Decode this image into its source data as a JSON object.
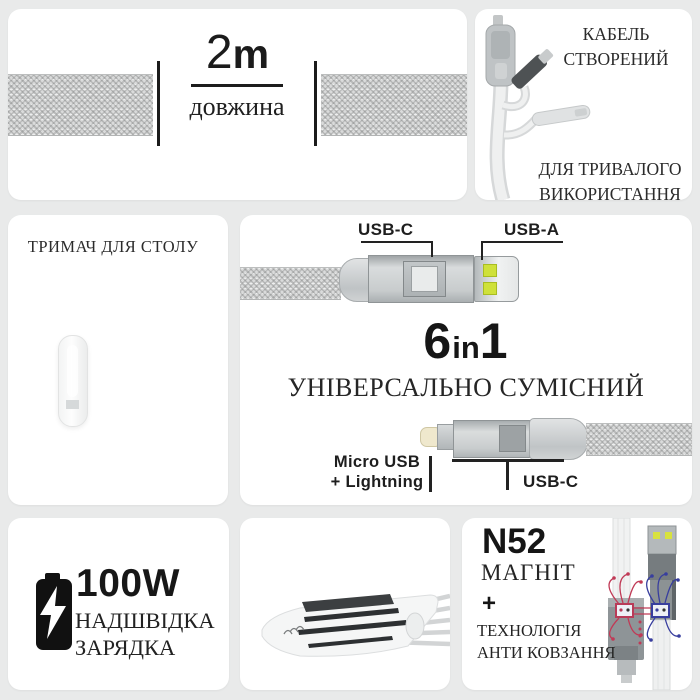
{
  "cards": {
    "length": {
      "value": "2",
      "unit": "m",
      "label": "довжина"
    },
    "durable": {
      "title_line1": "КАБЕЛЬ",
      "title_line2": "СТВОРЕНИЙ",
      "footer_line1": "ДЛЯ ТРИВАЛОГО",
      "footer_line2": "ВИКОРИСТАННЯ"
    },
    "holder": {
      "title": "ТРИМАЧ ДЛЯ СТОЛУ"
    },
    "main": {
      "label_usb_c_top": "USB-C",
      "label_usb_a": "USB-A",
      "badge_num1": "6",
      "badge_mid": "in",
      "badge_num2": "1",
      "subtitle": "УНІВЕРСАЛЬНО СУМІСНИЙ",
      "label_micro_line1": "Micro USB",
      "label_micro_line2": "+ Lightning",
      "label_usb_c_bottom": "USB-C"
    },
    "charge": {
      "power": "100W",
      "line1": "НАДШВІДКА",
      "line2": "ЗАРЯДКА"
    },
    "magnet": {
      "grade": "N52",
      "label": "МАГНІТ",
      "plus": "+",
      "tech_line1": "ТЕХНОЛОГІЯ",
      "tech_line2": "АНТИ КОВЗАННЯ"
    }
  },
  "icons": {
    "battery_charging": "battery-charging-icon",
    "braided_cable": "braided-cable-texture",
    "magnet_field": "magnetic-field-lines"
  },
  "colors": {
    "background": "#e9eaea",
    "card": "#ffffff",
    "text": "#1c1c1c",
    "usb_contact_yellow": "#cfe13a",
    "field_red": "#c03a56",
    "field_blue": "#383e9e"
  }
}
